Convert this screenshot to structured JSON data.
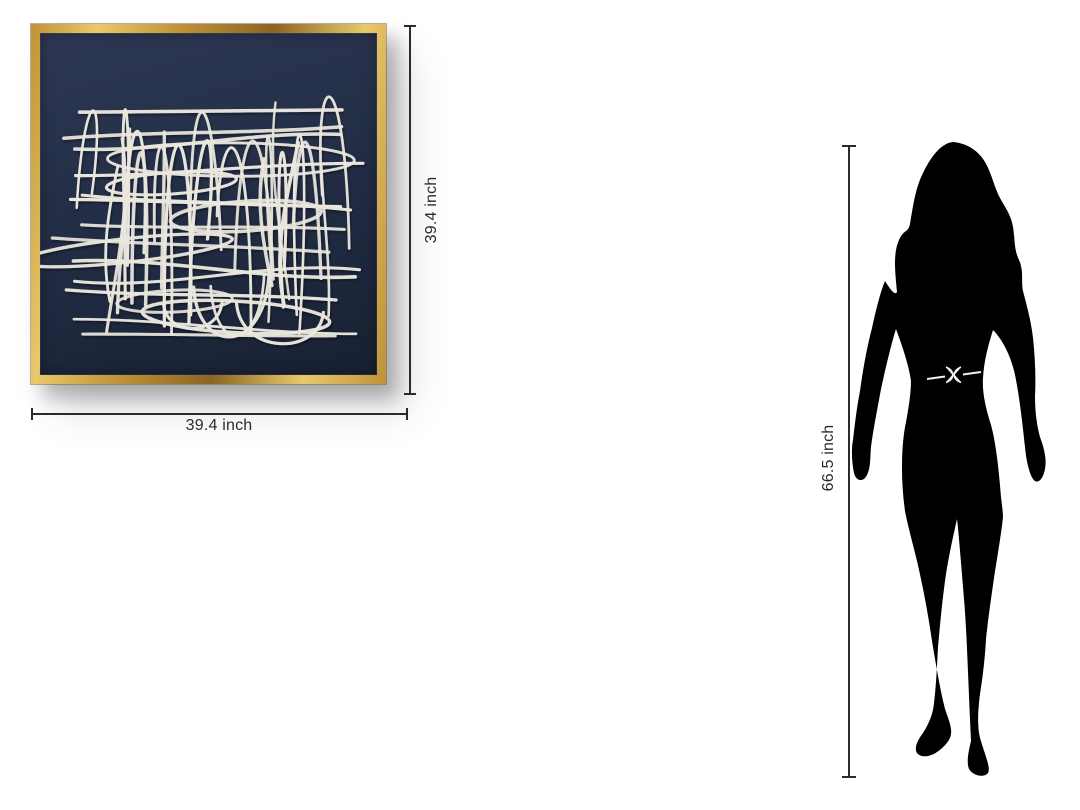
{
  "artwork": {
    "frame": {
      "width_label": "39.4 inch",
      "height_label": "39.4 inch"
    },
    "scribble": {
      "seed": 7,
      "arches": 15,
      "verticals": 8,
      "horizontals": 13,
      "ellipses": 6,
      "bottom_arcs": 4
    }
  },
  "figure": {
    "height_label": "66.5 inch"
  },
  "colors": {
    "gold-light": "#e8c96b",
    "gold-mid": "#bf9138",
    "gold-dark": "#8a6523",
    "canvas-top": "#2d3853",
    "canvas-mid": "#232e47",
    "canvas-bottom": "#182132",
    "string": "#eae7de",
    "ink": "#2b2b2b",
    "silhouette": "#000000",
    "belt": "#ffffff"
  }
}
